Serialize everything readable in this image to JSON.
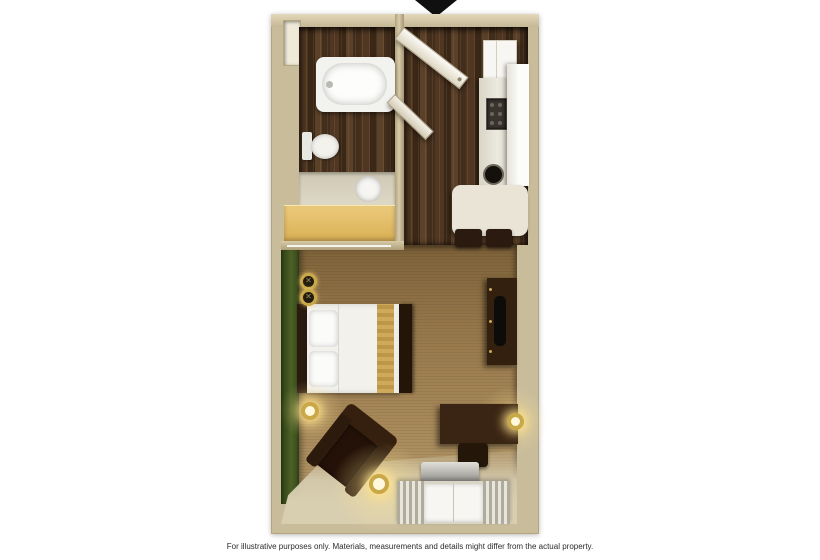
{
  "disclaimer": {
    "text": "For illustrative purposes only.  Materials, measurements and details might differ from the actual property."
  },
  "floor_plan": {
    "type": "studio-suite-top-down-3d-rendering",
    "entrance": {
      "indicator": "black-down-arrow",
      "position": "top-center"
    },
    "rooms": [
      {
        "name": "bathroom",
        "floor": "dark-wood",
        "features": [
          "bathtub",
          "toilet",
          "vanity-sink",
          "vanity-cabinet",
          "wall-niche",
          "towel-bar"
        ]
      },
      {
        "name": "entry-hall",
        "floor": "dark-wood",
        "features": [
          "entry-door-open",
          "bathroom-door-open"
        ]
      },
      {
        "name": "kitchen",
        "floor": "dark-wood",
        "features": [
          "upper-cabinet",
          "counter",
          "cooktop",
          "round-sink",
          "refrigerator",
          "dining-table",
          "two-dark-chairs"
        ]
      },
      {
        "name": "main-room",
        "floor": "tan-carpet",
        "features": [
          "green-accent-wall",
          "queen-bed",
          "pillows",
          "wall-sconces",
          "nightstand-lamp",
          "dresser-with-tv",
          "desk",
          "desk-chair",
          "desk-lamp",
          "armchair",
          "floor-lamp",
          "striped-sofa"
        ]
      }
    ],
    "colors": {
      "background": "#ffffff",
      "wall": "#c9bc9b",
      "wood_floor": "#46311f",
      "carpet": "#9b7d51",
      "accent_wall_green": "#42551f",
      "vanity_cabinet": "#e2bc66",
      "lamp_gold": "#c9a848",
      "fixture_white": "#f2f2ee",
      "furniture_dark_wood": "#33200f",
      "arrow_black": "#101010"
    },
    "sconce_glyph": "✕"
  }
}
